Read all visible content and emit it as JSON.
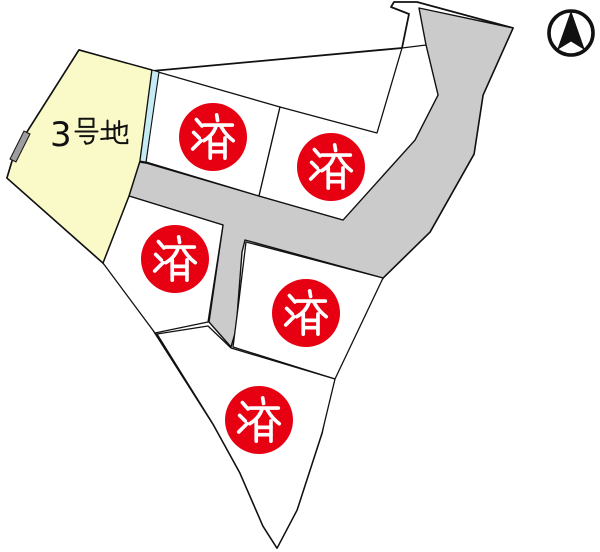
{
  "page": {
    "background": "#ffffff",
    "type": "land-lot-map"
  },
  "map": {
    "available_lot": {
      "name": "3号地",
      "number_digit": "3",
      "fill": "#FAFAC8",
      "status": "available"
    },
    "sold_stamp": "済",
    "sold_count": 5,
    "sold_lots": [
      {
        "stamp": "済"
      },
      {
        "stamp": "済"
      },
      {
        "stamp": "済"
      },
      {
        "stamp": "済"
      },
      {
        "stamp": "済"
      }
    ],
    "colors": {
      "badge": "#E60012",
      "stamp_text": "#FFFFFF",
      "road": "#CBCBCB",
      "waterway": "#C5EBF5",
      "outline": "#111111",
      "retaining_wall": "#9E9E9E",
      "available_fill": "#FAFAC8"
    },
    "compass": {
      "meaning": "north",
      "symbol": "north-arrow"
    }
  }
}
